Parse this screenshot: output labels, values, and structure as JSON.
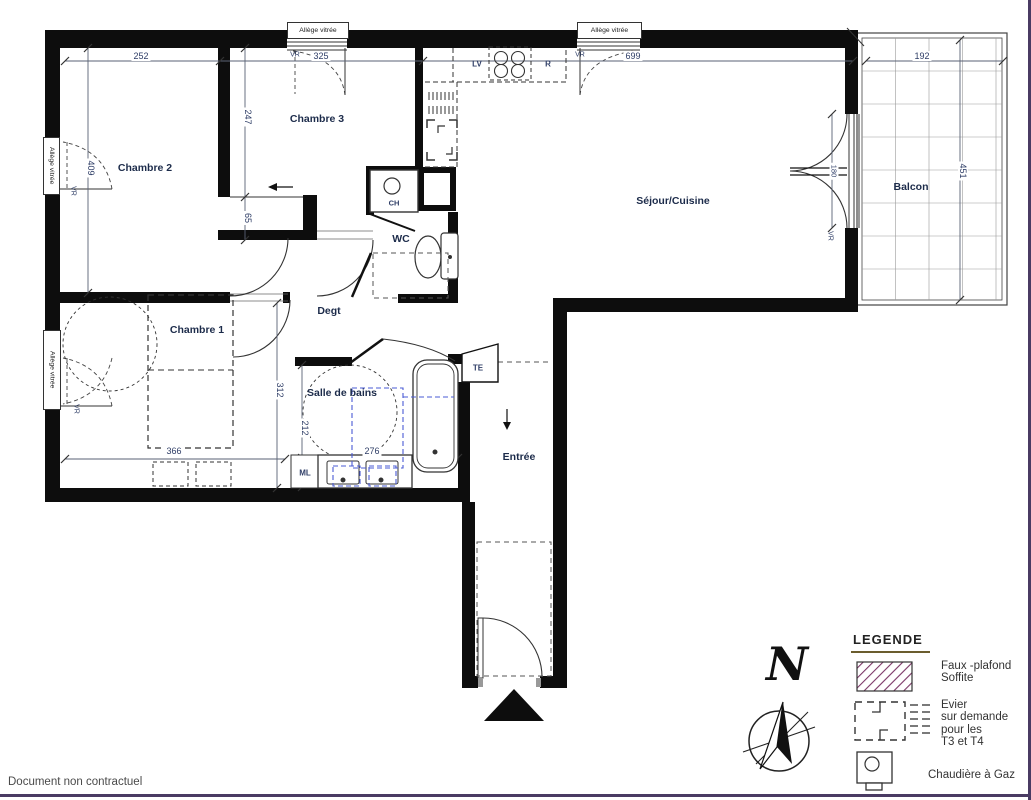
{
  "footer": {
    "disclaimer": "Document non contractuel"
  },
  "north": {
    "label": "N"
  },
  "legend": {
    "title": "LEGENDE",
    "items": [
      {
        "icon": "hatch-swatch",
        "label": "Faux -plafond\nSoffite"
      },
      {
        "icon": "evier-symbol",
        "label": "Evier\nsur demande\npour les\nT3 et T4"
      },
      {
        "icon": "gas-boiler-symbol",
        "label": "Chaudière à Gaz"
      }
    ]
  },
  "plan": {
    "rooms": {
      "chambre1": "Chambre 1",
      "chambre2": "Chambre 2",
      "chambre3": "Chambre 3",
      "sejour_cuisine": "Séjour/Cuisine",
      "balcon": "Balcon",
      "wc": "WC",
      "degagement": "Degt",
      "salle_de_bains": "Salle de bains",
      "entree": "Entrée"
    },
    "equipment": {
      "lave_vaisselle": "LV",
      "refrigerateur": "R",
      "chaudiere": "CH",
      "tableau_electrique": "TE",
      "machine_a_laver": "ML"
    },
    "window_labels": {
      "allege_vitree": "Allège vitrée",
      "volet_roulant": "VR"
    },
    "dimensions": {
      "top_chambre2": "252",
      "top_chambre3": "325",
      "top_sejour": "699",
      "balcon_width": "192",
      "balcon_height": "451",
      "chambre2_height": "409",
      "placard_wall": "247",
      "placard_depth": "65",
      "chambre1_width": "366",
      "chambre1_height": "312",
      "sdb_width": "276",
      "sdb_height": "212",
      "balcony_door": "180"
    }
  },
  "colors": {
    "wall": "#0d0d0d",
    "hatch_purple": "#7a3566",
    "optional_blue": "#4a5bd4",
    "dim_text": "#2e3d66",
    "page_border_purple": "#4a3b63",
    "legend_underline_olive": "#6b5d2e"
  }
}
